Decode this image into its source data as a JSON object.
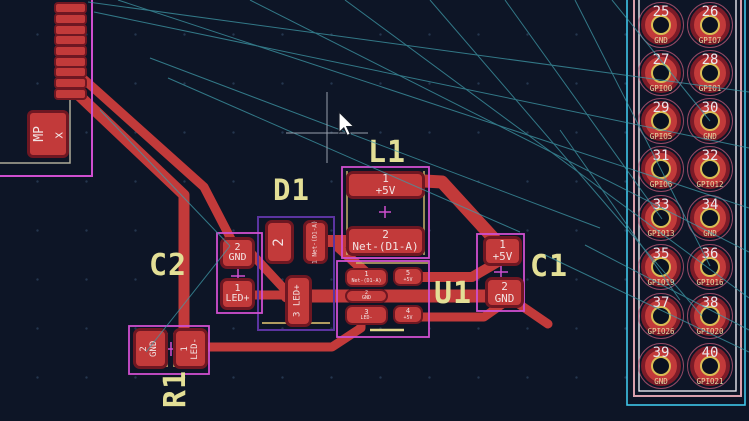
{
  "editor": {
    "view": "pcb-layout",
    "colors": {
      "background": "#0d1526",
      "copper": "#c23a3a",
      "pad_outline": "#6e1722",
      "silkscreen_magenta": "#cf4fcf",
      "silkscreen_violet": "#5b34a0",
      "courtyard_khaki": "#c9b168",
      "reference_label": "#e3df96",
      "ratsnest": "#3f9aa8",
      "edge_cyan": "#3fc6e8",
      "hole_ring": "#d9bd55"
    }
  },
  "components": {
    "L1": {
      "ref": "L1",
      "pads": [
        {
          "num": "1",
          "net": "+5V"
        },
        {
          "num": "2",
          "net": "Net-(D1-A)"
        }
      ]
    },
    "D1": {
      "ref": "D1",
      "pads": [
        {
          "num": "2",
          "net": ""
        },
        {
          "num": "1",
          "net": "Net-(D1-A)"
        },
        {
          "num": "3",
          "net": "LED+"
        }
      ]
    },
    "C2": {
      "ref": "C2",
      "pads": [
        {
          "num": "2",
          "net": "GND"
        },
        {
          "num": "1",
          "net": "LED+"
        }
      ]
    },
    "R1": {
      "ref": "R1",
      "pads": [
        {
          "num": "2",
          "net": "GND"
        },
        {
          "num": "1",
          "net": "LED-"
        }
      ]
    },
    "U1": {
      "ref": "U1",
      "pads": [
        {
          "num": "1",
          "net": "Net-(D1-A)"
        },
        {
          "num": "2",
          "net": "GND"
        },
        {
          "num": "3",
          "net": "LED-"
        },
        {
          "num": "5",
          "net": "+5V"
        },
        {
          "num": "4",
          "net": "+5V"
        }
      ]
    },
    "C1": {
      "ref": "C1",
      "pads": [
        {
          "num": "1",
          "net": "+5V"
        },
        {
          "num": "2",
          "net": "GND"
        }
      ]
    },
    "MP": {
      "ref": "MP",
      "net": "x"
    }
  },
  "header_connector": {
    "pins": [
      {
        "num": "25",
        "net": "GND"
      },
      {
        "num": "26",
        "net": "GPIO7"
      },
      {
        "num": "27",
        "net": "GPIO0"
      },
      {
        "num": "28",
        "net": "GPIO1"
      },
      {
        "num": "29",
        "net": "GPIO5"
      },
      {
        "num": "30",
        "net": "GND"
      },
      {
        "num": "31",
        "net": "GPIO6"
      },
      {
        "num": "32",
        "net": "GPIO12"
      },
      {
        "num": "33",
        "net": "GPIO13"
      },
      {
        "num": "34",
        "net": "GND"
      },
      {
        "num": "35",
        "net": "GPIO19"
      },
      {
        "num": "36",
        "net": "GPIO16"
      },
      {
        "num": "37",
        "net": "GPIO26"
      },
      {
        "num": "38",
        "net": "GPIO20"
      },
      {
        "num": "39",
        "net": "GND"
      },
      {
        "num": "40",
        "net": "GPIO21"
      }
    ]
  }
}
